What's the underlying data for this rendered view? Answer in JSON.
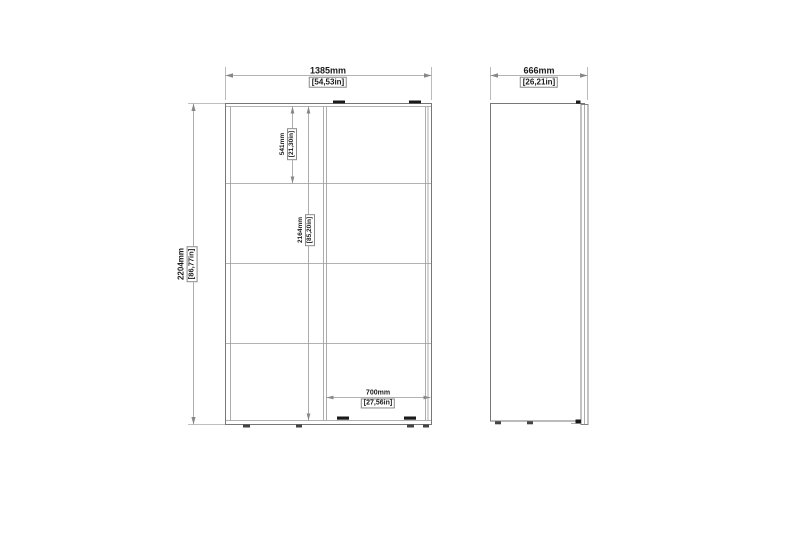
{
  "drawing": {
    "front_view": {
      "width": {
        "mm": "1385mm",
        "in": "[54,53in]"
      },
      "height": {
        "mm": "2204mm",
        "in": "[86,77in]"
      },
      "top_section": {
        "mm": "541mm",
        "in": "[21,30in]"
      },
      "interior_height": {
        "mm": "2164mm",
        "in": "[85,20in]"
      },
      "door_width": {
        "mm": "700mm",
        "in": "[27,56in]"
      }
    },
    "side_view": {
      "depth": {
        "mm": "666mm",
        "in": "[26,21in]"
      }
    },
    "colors": {
      "line": "#777777",
      "dim_line": "#999999",
      "extension_line": "#aaaaaa",
      "hardware": "#1a1a1a",
      "text": "#1a1a1a"
    }
  }
}
